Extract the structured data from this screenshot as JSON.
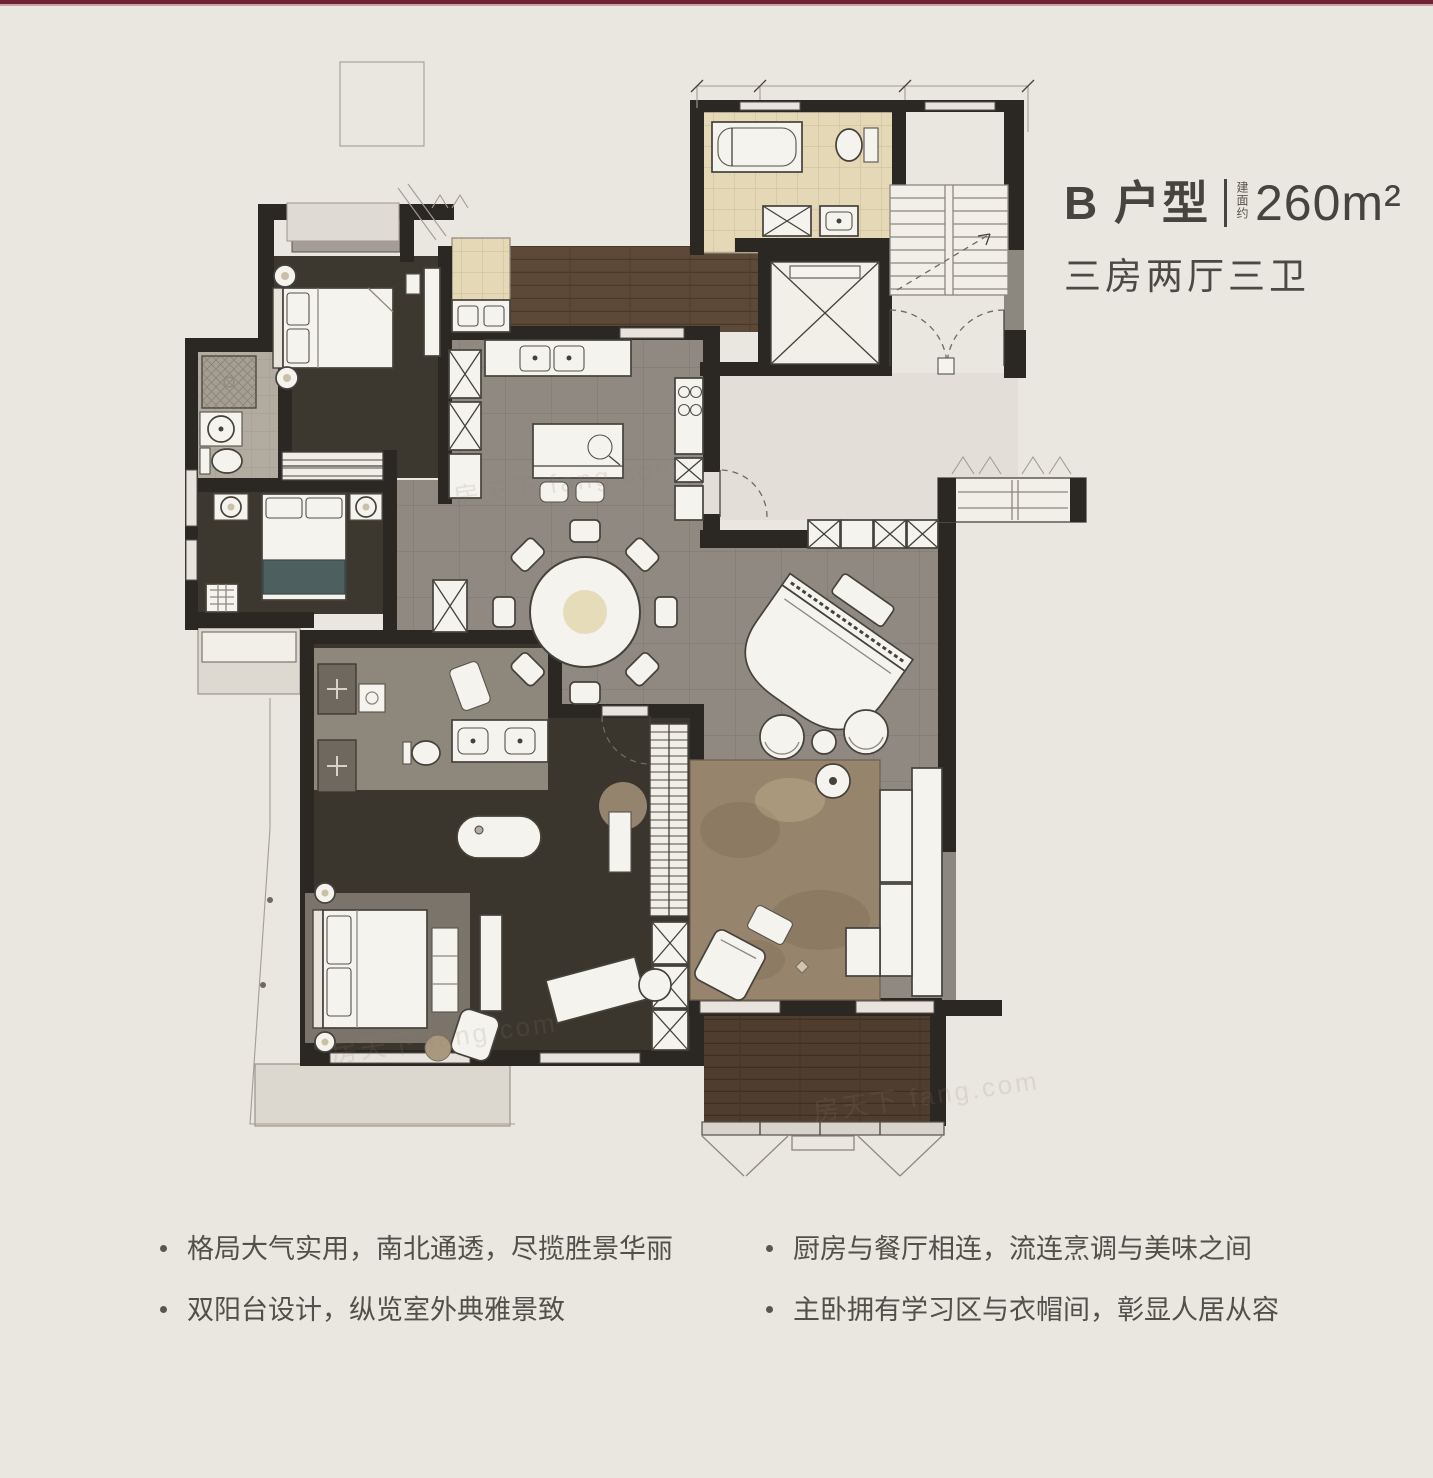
{
  "header": {
    "unit_label": "B 户型",
    "area_prefix": "建面约",
    "area_value": "260m²",
    "layout_line": "三房两厅三卫"
  },
  "features": {
    "left": [
      "格局大气实用，南北通透，尽揽胜景华丽",
      "双阳台设计，纵览室外典雅景致"
    ],
    "right": [
      "厨房与餐厅相连，流连烹调与美味之间",
      "主卧拥有学习区与衣帽间，彰显人居从容"
    ]
  },
  "watermark": {
    "text": "房天下 fang.com"
  },
  "colors": {
    "top_bar": "#6f2433",
    "paper": "#eae6e0",
    "wall": "#2b2823",
    "room_dark": "#3c382f",
    "tile_grey": "#8f8982",
    "foyer_light": "#e3dfd8",
    "wood_floor": "#5d4937",
    "balcony_wood": "#4f3d2e",
    "bath_beige": "#e5d8b6",
    "bath_grey": "#b2aba0",
    "furniture": "#f5f3ed",
    "rug_brown": "#97846c",
    "teal_accent": "#4e5f60"
  }
}
